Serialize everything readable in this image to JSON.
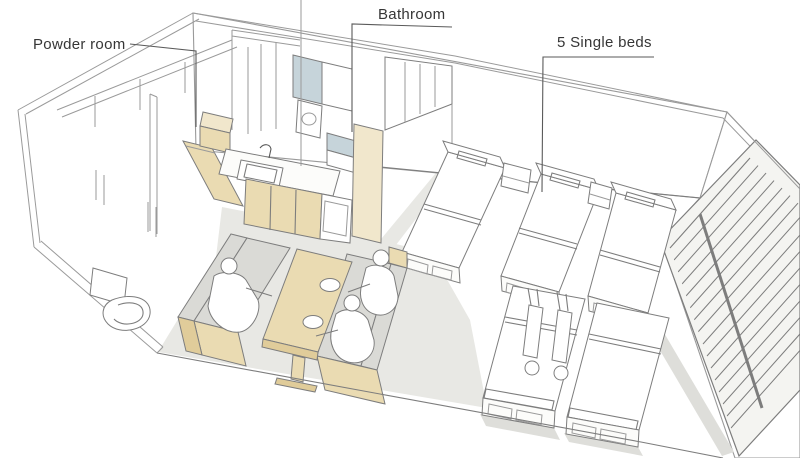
{
  "scene": {
    "description": "Hand-drawn perspective sketch of a studio apartment interior with kitchen, dining booth, bathroom, powder room and five single beds"
  },
  "annotations": {
    "powder_room": {
      "label": "Powder room"
    },
    "bathroom": {
      "label": "Bathroom"
    },
    "single_beds": {
      "label": "5 Single beds"
    }
  },
  "colors": {
    "paper": "#ffffff",
    "wood": "#eadbb2",
    "wood-light": "#f1e7cc",
    "wood-dark": "#e0cc9a",
    "floor": "#e8e8e4",
    "cushion": "#dadad6",
    "glass": "#c6d4da",
    "shadow": "#dededa",
    "line": "#9a9a9a",
    "line-mid": "#7d7d7d",
    "line-dark": "#5a5a5a",
    "text": "#363636"
  }
}
